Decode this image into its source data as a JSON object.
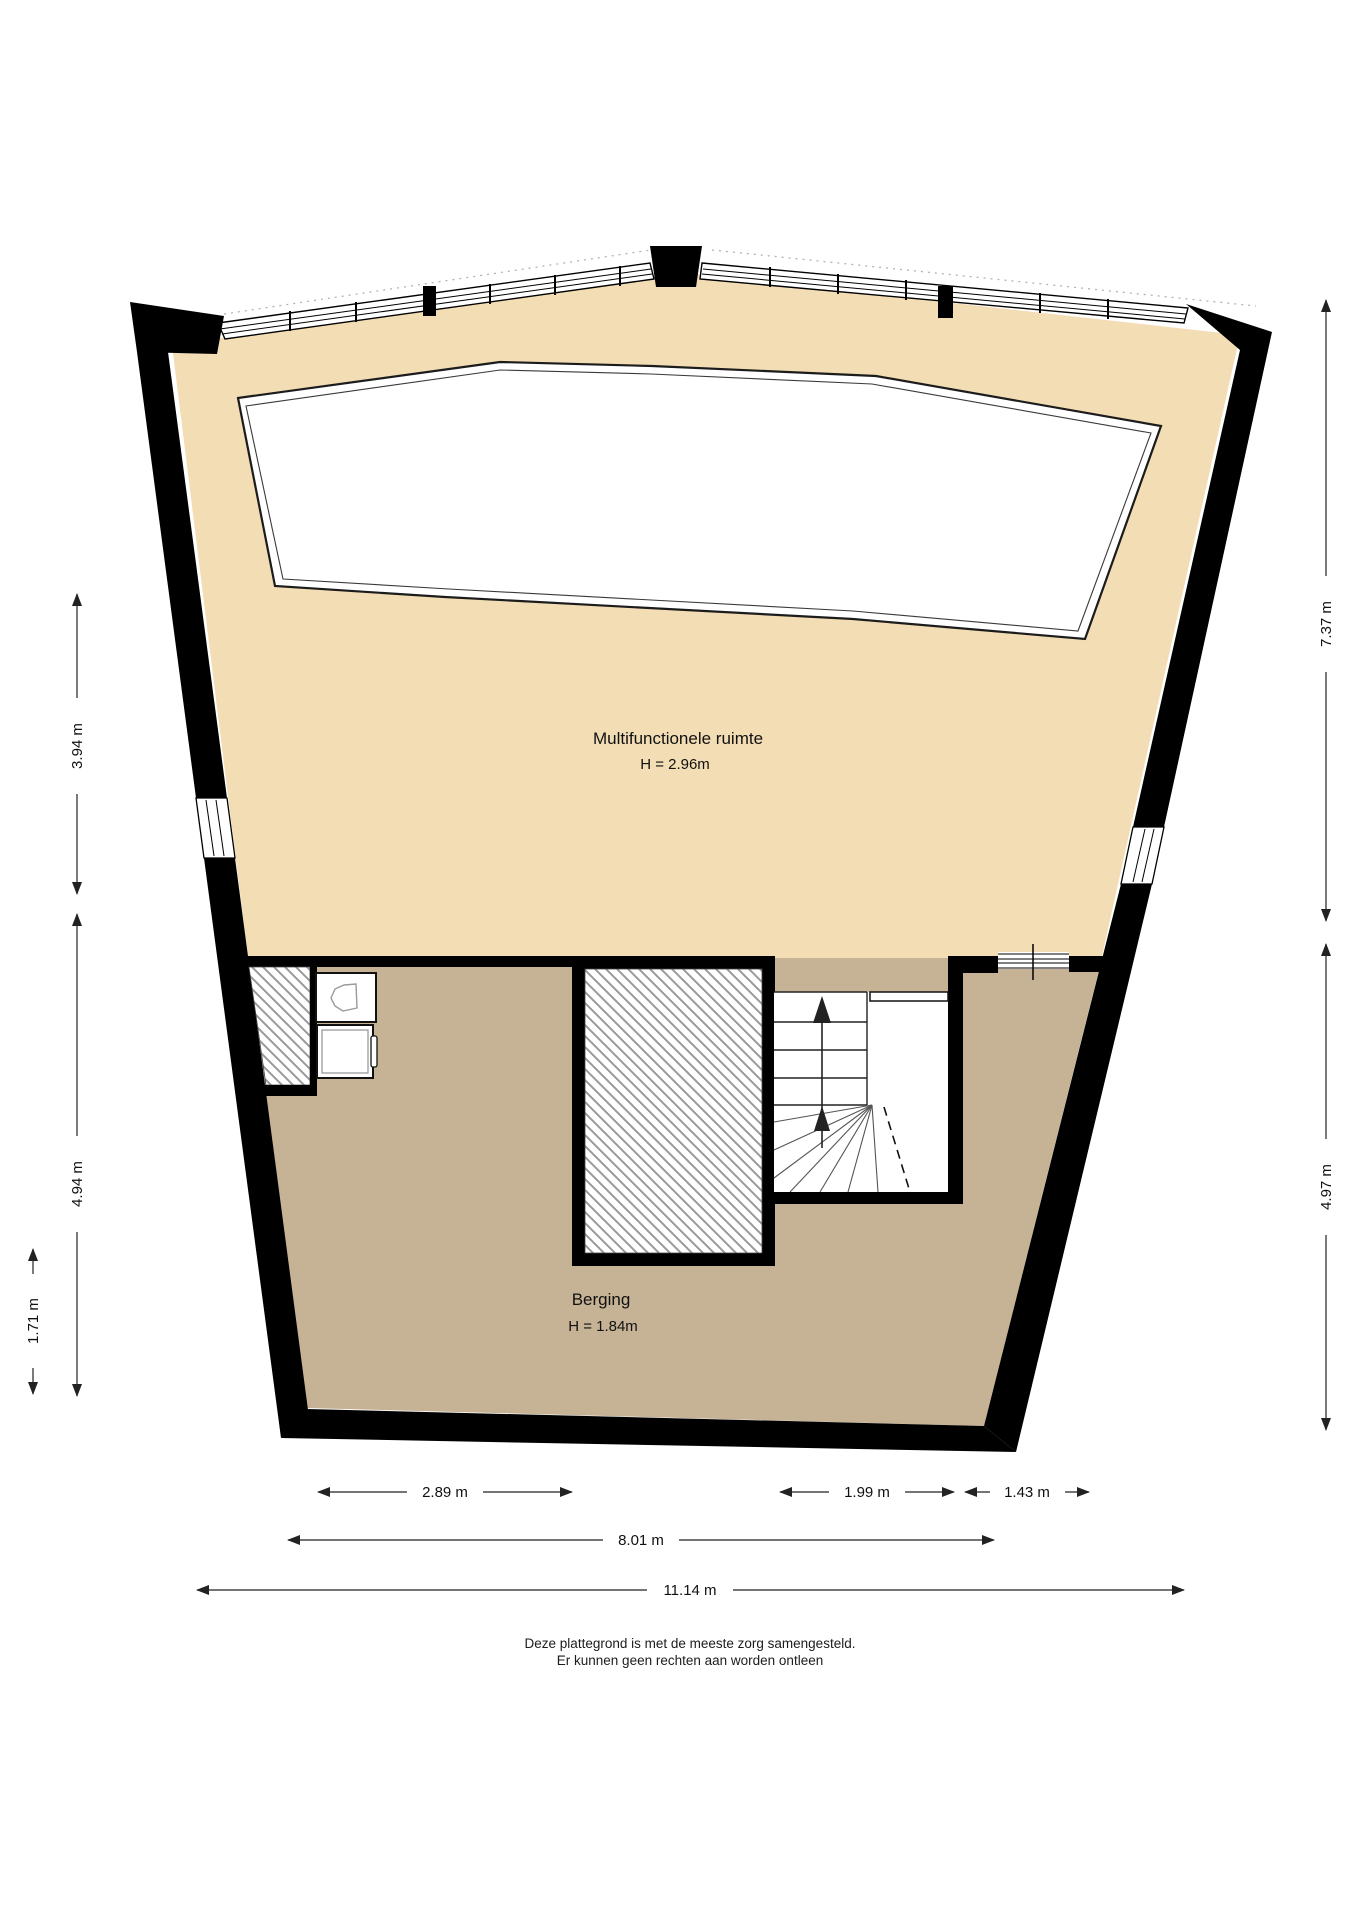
{
  "rooms": [
    {
      "name": "Multifunctionele ruimte",
      "height_label": "H = 2.96m"
    },
    {
      "name": "Berging",
      "height_label": "H = 1.84m"
    }
  ],
  "dimensions": {
    "left": [
      "3.94 m",
      "4.94 m",
      "1.71 m"
    ],
    "right": [
      "7.37 m",
      "4.97 m"
    ],
    "bottom": [
      "2.89 m",
      "1.99 m",
      "1.43 m",
      "8.01 m",
      "11.14 m"
    ]
  },
  "footer": {
    "line1": "Deze plattegrond is met de meeste zorg samengesteld.",
    "line2": "Er kunnen geen rechten aan worden ontleen"
  },
  "colors": {
    "floor_main": "#F2DDB4",
    "floor_storage": "#C6B295",
    "wall": "#000000",
    "hatch": "#9a9a9a",
    "background": "#FFFFFF"
  }
}
